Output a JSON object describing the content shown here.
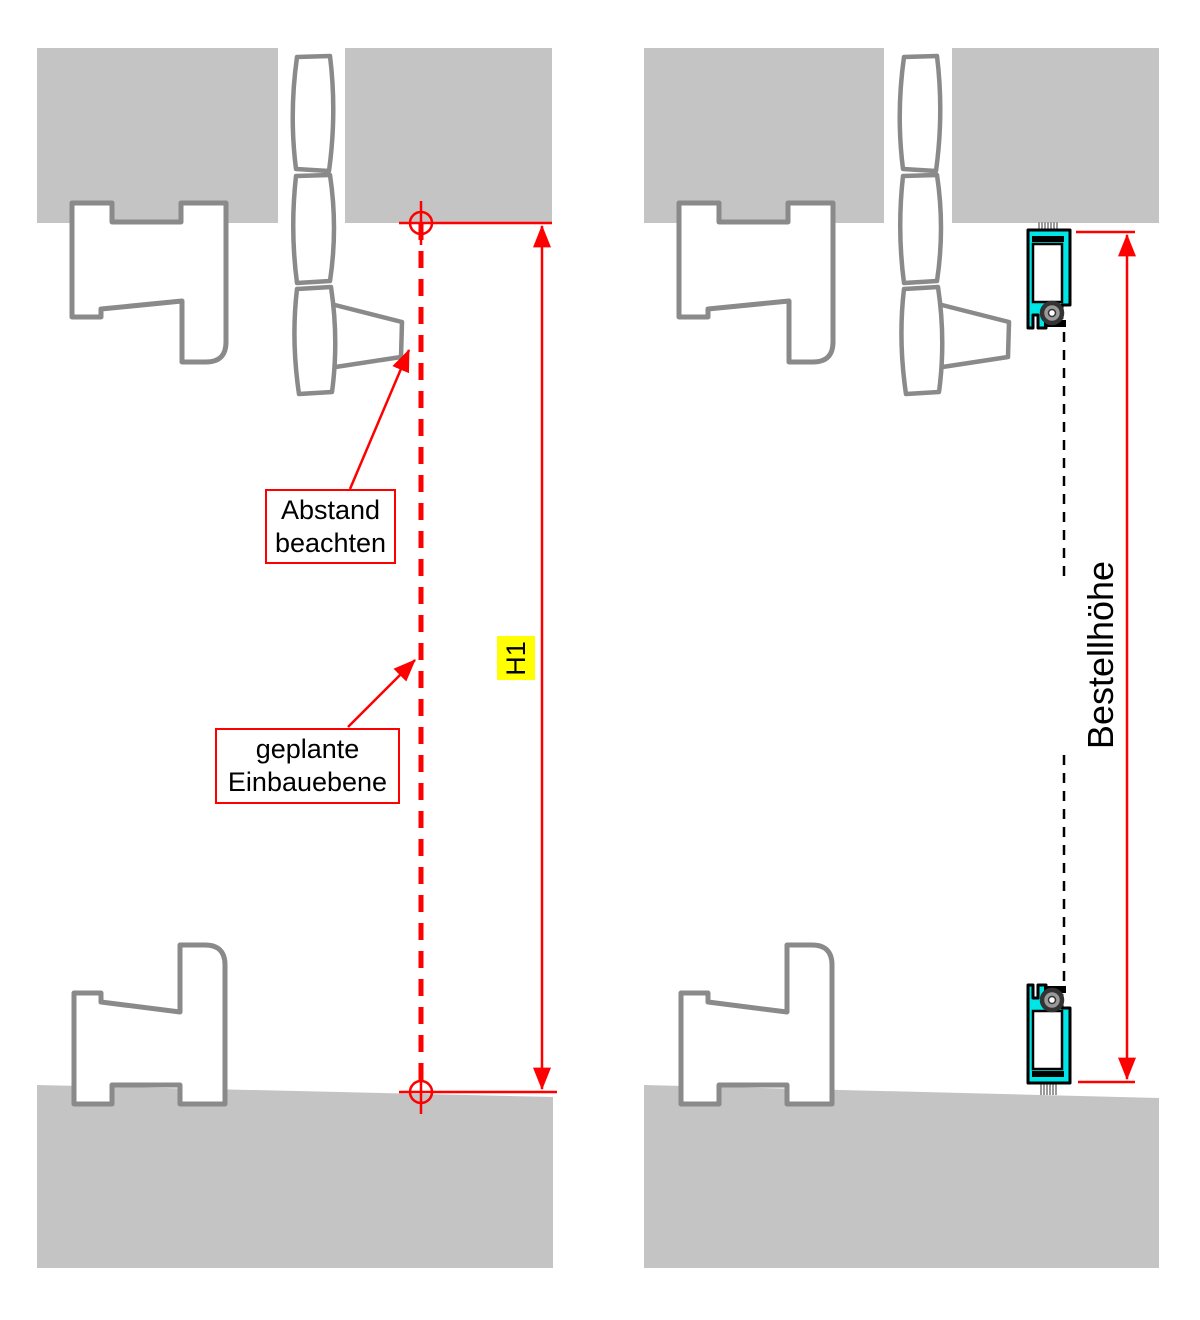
{
  "colors": {
    "annotation_red": "#ff0000",
    "track_cyan": "#00e5e6",
    "masonry_gray": "#c4c4c4",
    "profile_outline_gray": "#8a8a8a",
    "highlight_yellow": "#ffff00",
    "line_black": "#000000"
  },
  "left_panel": {
    "dimension_label": "H1",
    "callouts": [
      {
        "lines": [
          "Abstand",
          "beachten"
        ]
      },
      {
        "lines": [
          "geplante",
          "Einbauebene"
        ]
      }
    ]
  },
  "right_panel": {
    "dimension_label": "Bestellhöhe"
  }
}
